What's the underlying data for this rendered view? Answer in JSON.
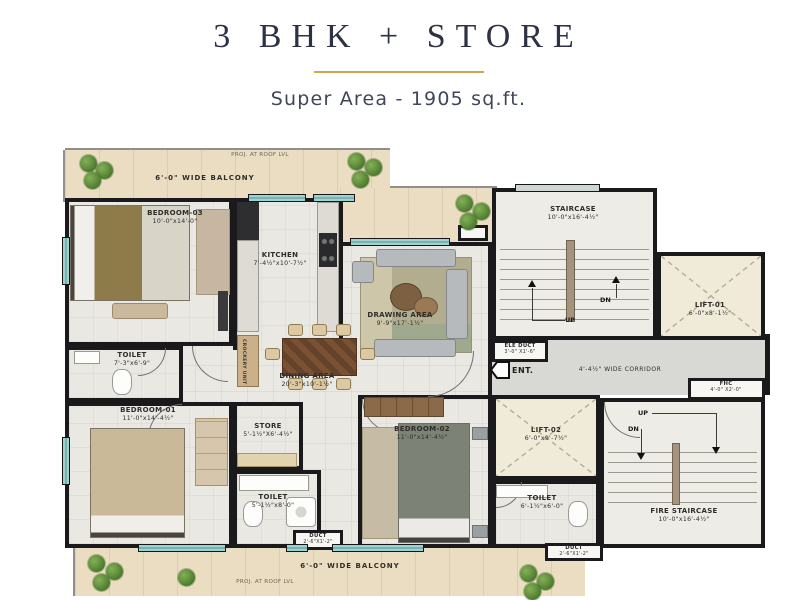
{
  "header": {
    "title": "3 BHK + STORE",
    "subtitle": "Super Area - 1905 sq.ft."
  },
  "plan": {
    "balcony_top": {
      "label": "6'-0\" WIDE BALCONY",
      "proj": "PROJ. AT ROOF LVL"
    },
    "balcony_bottom": {
      "label": "6'-0\" WIDE BALCONY",
      "proj": "PROJ. AT ROOF LVL"
    },
    "rooms": {
      "bedroom03": {
        "name": "BEDROOM-03",
        "dim": "10'-0\"x14'-0\""
      },
      "kitchen": {
        "name": "KITCHEN",
        "dim": "7'-4½\"x10'-7½\"",
        "crockery": "CROCKERY UNIT"
      },
      "drawing": {
        "name": "DRAWING AREA",
        "dim": "9'-9\"x17'-1½\""
      },
      "dining": {
        "name": "DINING AREA",
        "dim": "20'-3\"x10'-1½\""
      },
      "store": {
        "name": "STORE",
        "dim": "5'-1½\"X6'-4½\""
      },
      "bedroom01": {
        "name": "BEDROOM-01",
        "dim": "11'-0\"x14'-4½\""
      },
      "bedroom02": {
        "name": "BEDROOM-02",
        "dim": "11'-0\"x14'-4½\""
      },
      "toilet1": {
        "name": "TOILET",
        "dim": "7'-3\"x6'-9\""
      },
      "toilet2": {
        "name": "TOILET",
        "dim": "5'-1½\"x8'-0\""
      },
      "toilet3": {
        "name": "TOILET",
        "dim": "6'-1½\"x6'-0\""
      },
      "staircase": {
        "name": "STAIRCASE",
        "dim": "10'-0\"x16'-4½\""
      },
      "fire_staircase": {
        "name": "FIRE STAIRCASE",
        "dim": "10'-0\"x16'-4½\""
      },
      "lift01": {
        "name": "LIFT-01",
        "dim": "6'-0\"x8'-1½\""
      },
      "lift02": {
        "name": "LIFT-02",
        "dim": "6'-0\"x9'-7½\""
      },
      "fhc": {
        "name": "FHC",
        "dim": "4'-0\" X2'-0\""
      },
      "ele_duct": {
        "name": "ELE DUCT",
        "dim": "3'-0\" X1'-6\""
      },
      "duct": {
        "name": "DUCT",
        "dim": "2'-6\"X1'-2\""
      },
      "corridor": {
        "label": "4'-4½\" WIDE CORRIDOR"
      }
    },
    "markers": {
      "ent": "ENT.",
      "up": "UP",
      "dn": "DN"
    },
    "colors": {
      "accent_gold": "#c9a850",
      "title_text": "#2c3143",
      "wall": "#1a1a1c",
      "floor": "#e9e8e3",
      "balcony": "#ebddc1",
      "corridor": "#d8d8d5",
      "lift": "#f0ebd8",
      "window": "#9fd2d2",
      "plant": "#4c7a2e"
    }
  }
}
